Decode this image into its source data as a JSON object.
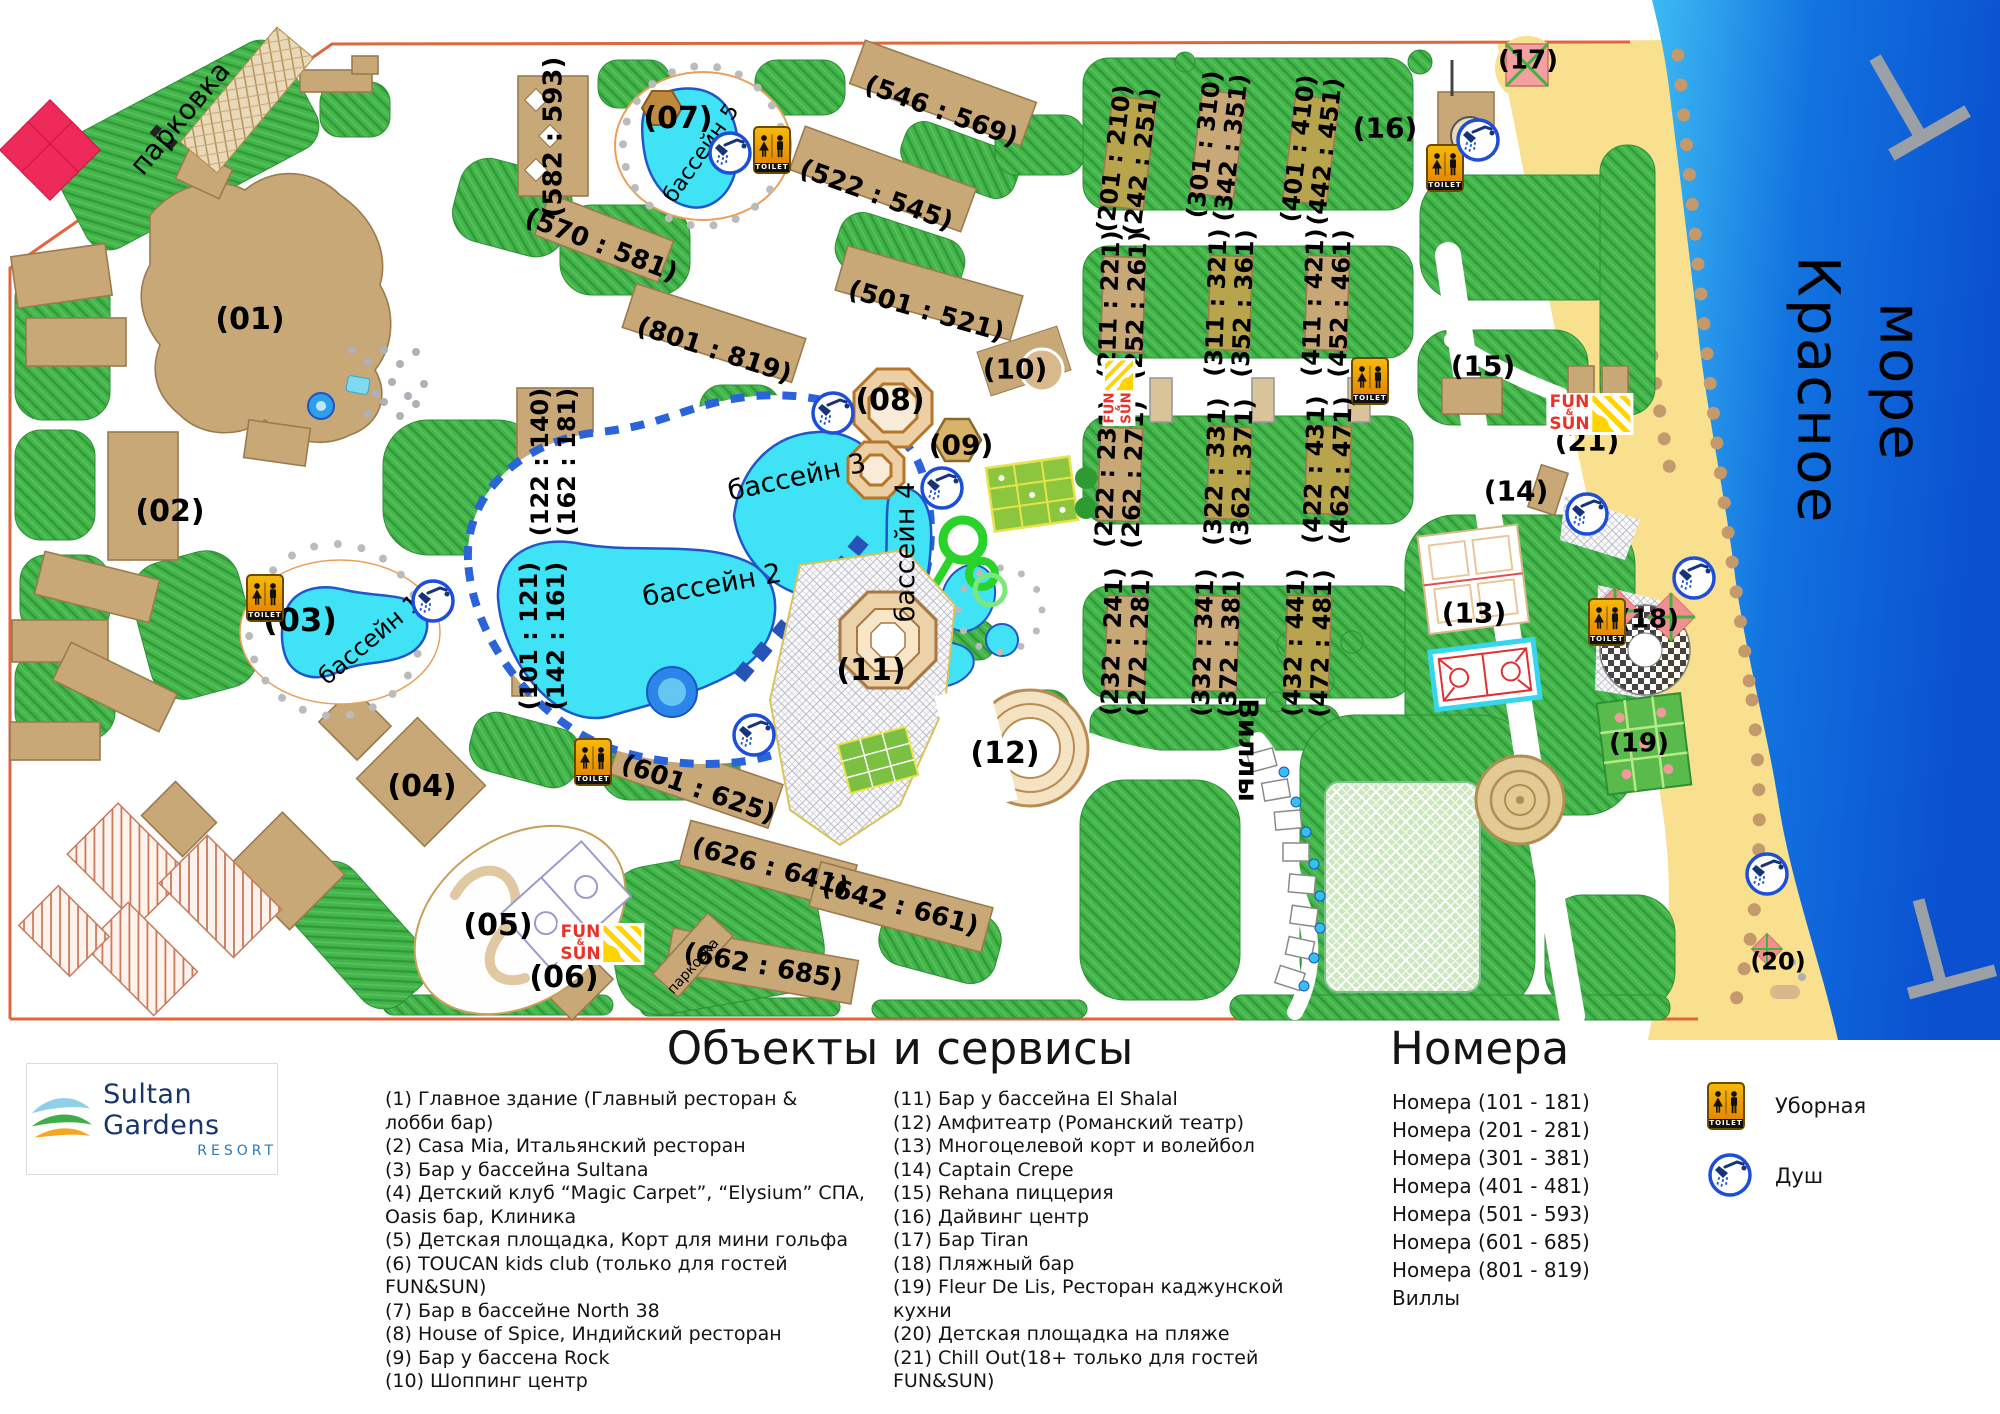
{
  "map": {
    "toilet_sign": "TOILET",
    "funsun": {
      "top": "FUN",
      "amp": "&",
      "bottom": "SUN"
    },
    "labels": [
      {
        "id": "parking-main",
        "text": "парковка",
        "x": 180,
        "y": 118,
        "rot": -50,
        "size": 28,
        "kind": "place"
      },
      {
        "id": "num-01",
        "text": "(01)",
        "x": 250,
        "y": 320,
        "rot": 0,
        "size": 30
      },
      {
        "id": "num-02",
        "text": "(02)",
        "x": 170,
        "y": 512,
        "rot": 0,
        "size": 30
      },
      {
        "id": "num-03",
        "text": "(03)",
        "x": 300,
        "y": 621,
        "rot": 0,
        "size": 32
      },
      {
        "id": "num-04",
        "text": "(04)",
        "x": 422,
        "y": 787,
        "rot": 0,
        "size": 30
      },
      {
        "id": "num-05",
        "text": "(05)",
        "x": 498,
        "y": 926,
        "rot": 0,
        "size": 30
      },
      {
        "id": "num-06",
        "text": "(06)",
        "x": 564,
        "y": 978,
        "rot": 0,
        "size": 30
      },
      {
        "id": "num-07",
        "text": "(07)",
        "x": 678,
        "y": 119,
        "rot": 0,
        "size": 30
      },
      {
        "id": "num-08",
        "text": "(08)",
        "x": 890,
        "y": 401,
        "rot": 0,
        "size": 30
      },
      {
        "id": "num-09",
        "text": "(09)",
        "x": 961,
        "y": 445,
        "rot": 0,
        "size": 28
      },
      {
        "id": "num-10",
        "text": "(10)",
        "x": 1015,
        "y": 369,
        "rot": 0,
        "size": 28
      },
      {
        "id": "num-11",
        "text": "(11)",
        "x": 871,
        "y": 671,
        "rot": 0,
        "size": 30
      },
      {
        "id": "num-12",
        "text": "(12)",
        "x": 1005,
        "y": 754,
        "rot": 0,
        "size": 30
      },
      {
        "id": "num-13",
        "text": "(13)",
        "x": 1474,
        "y": 613,
        "rot": 0,
        "size": 28
      },
      {
        "id": "num-14",
        "text": "(14)",
        "x": 1516,
        "y": 491,
        "rot": 0,
        "size": 28
      },
      {
        "id": "num-15",
        "text": "(15)",
        "x": 1483,
        "y": 366,
        "rot": 0,
        "size": 28
      },
      {
        "id": "num-16",
        "text": "(16)",
        "x": 1385,
        "y": 128,
        "rot": 0,
        "size": 28
      },
      {
        "id": "num-17",
        "text": "(17)",
        "x": 1528,
        "y": 61,
        "rot": 0,
        "size": 26
      },
      {
        "id": "num-18",
        "text": "(18)",
        "x": 1649,
        "y": 620,
        "rot": 0,
        "size": 26
      },
      {
        "id": "num-19",
        "text": "(19)",
        "x": 1639,
        "y": 744,
        "rot": 0,
        "size": 26
      },
      {
        "id": "num-20",
        "text": "(20)",
        "x": 1778,
        "y": 962,
        "rot": 0,
        "size": 24
      },
      {
        "id": "num-21",
        "text": "(21)",
        "x": 1587,
        "y": 441,
        "rot": 0,
        "size": 28
      },
      {
        "id": "rng-582",
        "text": "(582 : 593)",
        "x": 554,
        "y": 137,
        "rot": -90,
        "size": 26
      },
      {
        "id": "rng-570",
        "text": "(570 : 581)",
        "x": 601,
        "y": 246,
        "rot": 21,
        "size": 26
      },
      {
        "id": "rng-546",
        "text": "(546 : 569)",
        "x": 941,
        "y": 112,
        "rot": 20,
        "size": 26
      },
      {
        "id": "rng-522",
        "text": "(522 : 545)",
        "x": 876,
        "y": 196,
        "rot": 20,
        "size": 26
      },
      {
        "id": "rng-501",
        "text": "(501 : 521)",
        "x": 926,
        "y": 312,
        "rot": 16,
        "size": 26
      },
      {
        "id": "rng-801",
        "text": "(801 : 819)",
        "x": 714,
        "y": 351,
        "rot": 18,
        "size": 26
      },
      {
        "id": "rng-601",
        "text": "(601 : 625)",
        "x": 698,
        "y": 790,
        "rot": 19,
        "size": 26
      },
      {
        "id": "rng-626",
        "text": "(626 : 641)",
        "x": 770,
        "y": 868,
        "rot": 15,
        "size": 26
      },
      {
        "id": "rng-642",
        "text": "(642 : 661)",
        "x": 900,
        "y": 907,
        "rot": 15,
        "size": 26
      },
      {
        "id": "rng-662",
        "text": "(662 : 685)",
        "x": 763,
        "y": 967,
        "rot": 10,
        "size": 26
      },
      {
        "id": "parking-small",
        "text": "парковка",
        "x": 694,
        "y": 967,
        "rot": -48,
        "size": 14,
        "kind": "place"
      },
      {
        "id": "rng-122",
        "text": "(122 : 140)\n(162 : 181)",
        "x": 554,
        "y": 462,
        "rot": -90,
        "size": 24
      },
      {
        "id": "rng-101",
        "text": "(101 : 121)\n(142 : 161)",
        "x": 543,
        "y": 636,
        "rot": -90,
        "size": 24
      },
      {
        "id": "rng-201",
        "text": "(201 : 210)\n(242 : 251)",
        "x": 1128,
        "y": 160,
        "rot": -83,
        "size": 24
      },
      {
        "id": "rng-301",
        "text": "(301 : 310)\n(342 : 351)",
        "x": 1218,
        "y": 146,
        "rot": -83,
        "size": 24
      },
      {
        "id": "rng-401",
        "text": "(401 : 410)\n(442 : 451)",
        "x": 1312,
        "y": 150,
        "rot": -83,
        "size": 24
      },
      {
        "id": "rng-211",
        "text": "(211 : 221)\n(252 : 261)",
        "x": 1123,
        "y": 305,
        "rot": -88,
        "size": 24
      },
      {
        "id": "rng-311",
        "text": "(311 : 321)\n(352 : 361)",
        "x": 1230,
        "y": 303,
        "rot": -88,
        "size": 24
      },
      {
        "id": "rng-411",
        "text": "(411 : 421)\n(452 : 461)",
        "x": 1327,
        "y": 303,
        "rot": -88,
        "size": 24
      },
      {
        "id": "rng-222",
        "text": "(222 : 231)\n(262 : 271)",
        "x": 1120,
        "y": 474,
        "rot": -88,
        "size": 24
      },
      {
        "id": "rng-322",
        "text": "(322 : 331)\n(362 : 371)",
        "x": 1229,
        "y": 472,
        "rot": -88,
        "size": 24
      },
      {
        "id": "rng-422",
        "text": "(422 : 431)\n(462 : 471)",
        "x": 1328,
        "y": 470,
        "rot": -88,
        "size": 24
      },
      {
        "id": "rng-232",
        "text": "(232 : 241)\n(272 : 281)",
        "x": 1126,
        "y": 642,
        "rot": -88,
        "size": 24
      },
      {
        "id": "rng-332",
        "text": "(332 : 341)\n(372 : 381)",
        "x": 1217,
        "y": 643,
        "rot": -88,
        "size": 24
      },
      {
        "id": "rng-432",
        "text": "(432 : 441)\n(472 : 481)",
        "x": 1308,
        "y": 643,
        "rot": -88,
        "size": 24
      },
      {
        "id": "pool-1",
        "text": "бассейн 1",
        "x": 370,
        "y": 640,
        "rot": -40,
        "size": 24,
        "kind": "pool"
      },
      {
        "id": "pool-2",
        "text": "бассейн 2",
        "x": 712,
        "y": 586,
        "rot": -10,
        "size": 27,
        "kind": "pool"
      },
      {
        "id": "pool-3",
        "text": "бассейн 3",
        "x": 797,
        "y": 478,
        "rot": -12,
        "size": 27,
        "kind": "pool"
      },
      {
        "id": "pool-4",
        "text": "бассейн 4",
        "x": 906,
        "y": 552,
        "rot": -90,
        "size": 27,
        "kind": "pool"
      },
      {
        "id": "pool-5",
        "text": "бассейн 5",
        "x": 702,
        "y": 154,
        "rot": -55,
        "size": 22,
        "kind": "pool"
      },
      {
        "id": "villas",
        "text": "Виллы",
        "x": 1247,
        "y": 750,
        "rot": 90,
        "size": 27
      },
      {
        "id": "sea-1",
        "text": "Красное",
        "x": 1818,
        "y": 390,
        "rot": 90,
        "size": 58,
        "kind": "sea"
      },
      {
        "id": "sea-2",
        "text": "море",
        "x": 1900,
        "y": 382,
        "rot": 90,
        "size": 58,
        "kind": "sea"
      }
    ],
    "toilets": [
      {
        "x": 772,
        "y": 150
      },
      {
        "x": 1445,
        "y": 168
      },
      {
        "x": 1370,
        "y": 381
      },
      {
        "x": 265,
        "y": 598
      },
      {
        "x": 593,
        "y": 762
      },
      {
        "x": 1607,
        "y": 622
      }
    ],
    "showers": [
      {
        "x": 730,
        "y": 153
      },
      {
        "x": 1478,
        "y": 140
      },
      {
        "x": 833,
        "y": 413
      },
      {
        "x": 942,
        "y": 488
      },
      {
        "x": 433,
        "y": 601
      },
      {
        "x": 754,
        "y": 735
      },
      {
        "x": 1587,
        "y": 514
      },
      {
        "x": 1694,
        "y": 578
      },
      {
        "x": 1767,
        "y": 874
      }
    ],
    "funsun_marks": [
      {
        "x": 1590,
        "y": 414,
        "rot": 0,
        "s": 1
      },
      {
        "x": 601,
        "y": 944,
        "rot": 0,
        "s": 1
      },
      {
        "x": 1119,
        "y": 392,
        "rot": -90,
        "s": 0.78
      }
    ]
  },
  "legend": {
    "services_title": "Объекты и сервисы",
    "rooms_title": "Номера",
    "services_col1": [
      "(1) Главное здание (Главный ресторан &\nлобби бар)",
      "(2) Casa Mia, Итальянский ресторан",
      "(3) Бар у бассейна Sultana",
      "(4) Детский клуб “Magic Carpet”, “Elysium” СПА,\nOasis бар, Клиника",
      "(5) Детская площадка, Корт для мини гольфа",
      "(6) TOUCAN kids club (только для гостей\nFUN&SUN)",
      "(7) Бар в бассейне North 38",
      "(8) House of Spice, Индийский ресторан",
      "(9) Бар у бассена Rock",
      "(10) Шоппинг центр"
    ],
    "services_col2": [
      "(11) Бар у бассейна El Shalal",
      "(12) Амфитеатр (Романский театр)",
      "(13) Многоцелевой корт и волейбол",
      "(14) Captain Crepe",
      "(15) Rehana пиццерия",
      "(16) Дайвинг центр",
      "(17) Бар Tiran",
      "(18) Пляжный бар",
      "(19) Fleur De Lis, Ресторан каджунской\nкухни",
      "(20) Детская площадка на пляже",
      "(21) Chill Out(18+ только для гостей\nFUN&SUN)"
    ],
    "rooms": [
      "Номера (101 - 181)",
      "Номера (201 - 281)",
      "Номера (301 - 381)",
      "Номера (401 - 481)",
      "Номера (501 - 593)",
      "Номера (601 - 685)",
      "Номера (801 - 819)",
      "Виллы"
    ],
    "icons": [
      {
        "name": "toilet",
        "label": "Уборная"
      },
      {
        "name": "shower",
        "label": "Душ"
      }
    ]
  },
  "logo": {
    "name": "Sultan Gardens",
    "subtitle": "RESORT"
  },
  "colors": {
    "sea_dark": "#0a50cf",
    "sea_light": "#3dbaf2",
    "sand": "#f9e08f",
    "grass": "#44b54b",
    "building": "#c9a877",
    "building_olive": "#b7a44c",
    "pool": "#3fe3f5",
    "boundary": "#e0663c",
    "funsun_red": "#e8332a",
    "toilet_orange": "#f0a500"
  }
}
